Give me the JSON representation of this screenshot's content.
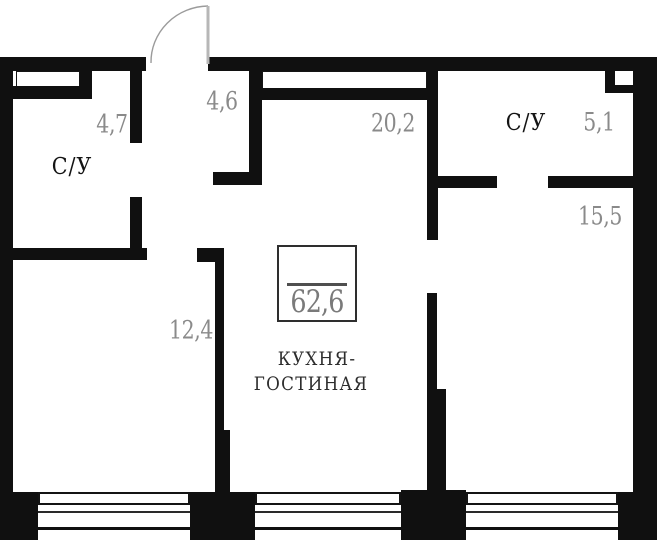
{
  "floorplan": {
    "total": {
      "area": "62,6"
    },
    "rooms": {
      "bathroom_left": {
        "name": "С/У",
        "area": "4,7"
      },
      "hallway": {
        "area": "4,6"
      },
      "kitchen_living": {
        "name_line1": "КУХНЯ-",
        "name_line2": "ГОСТИНАЯ",
        "area": "20,2"
      },
      "bathroom_right": {
        "name": "С/У",
        "area": "5,1"
      },
      "bedroom": {
        "area": "15,5"
      },
      "room_small": {
        "area": "12,4"
      }
    },
    "colors": {
      "wall": "#101010",
      "area_label": "#8a8a8a",
      "room_label": "#141414",
      "door": "#9b9b9b"
    }
  }
}
